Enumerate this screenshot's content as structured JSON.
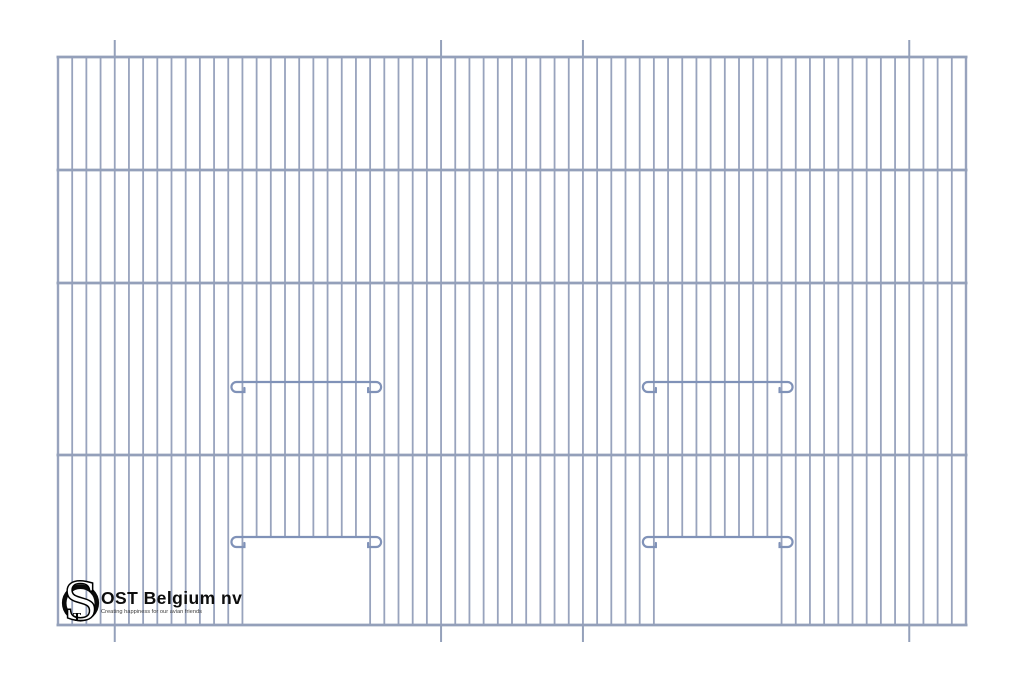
{
  "page": {
    "width": 1024,
    "height": 683,
    "background": "#ffffff"
  },
  "drawing": {
    "description": "cage front panel wire diagram with two sliding doors",
    "colors": {
      "wire": "#98a3bd",
      "frame_bar": "#94a0ba",
      "tick": "#94a0ba",
      "door_bar": "#8092b8"
    },
    "frame": {
      "left": 58,
      "right": 966,
      "top": 57,
      "bottom": 625
    },
    "wire_count": 65,
    "wire_width": 1.8,
    "edge_wire_width": 2.4,
    "horizontal_bar_ys": [
      57,
      170,
      283,
      455,
      625
    ],
    "bar_width": 2.8,
    "mount_ticks": {
      "indices": [
        4,
        27,
        37,
        60
      ],
      "length": 17,
      "width": 2
    },
    "doors": [
      {
        "left_wire_index": 13,
        "right_wire_index": 22,
        "slide_bar_y": 382,
        "opening_top_y": 537
      },
      {
        "left_wire_index": 42,
        "right_wire_index": 51,
        "slide_bar_y": 382,
        "opening_top_y": 537
      }
    ],
    "door_bar_width": 2.2,
    "curl": {
      "radius": 5,
      "overhang": 11,
      "stub": 8,
      "tick": 4
    }
  },
  "branding": {
    "company_name": "OST Belgium nv",
    "tagline": "Creating happiness for our avian friends",
    "monogram_letter_s": "S",
    "monogram_letter_t": "T"
  }
}
